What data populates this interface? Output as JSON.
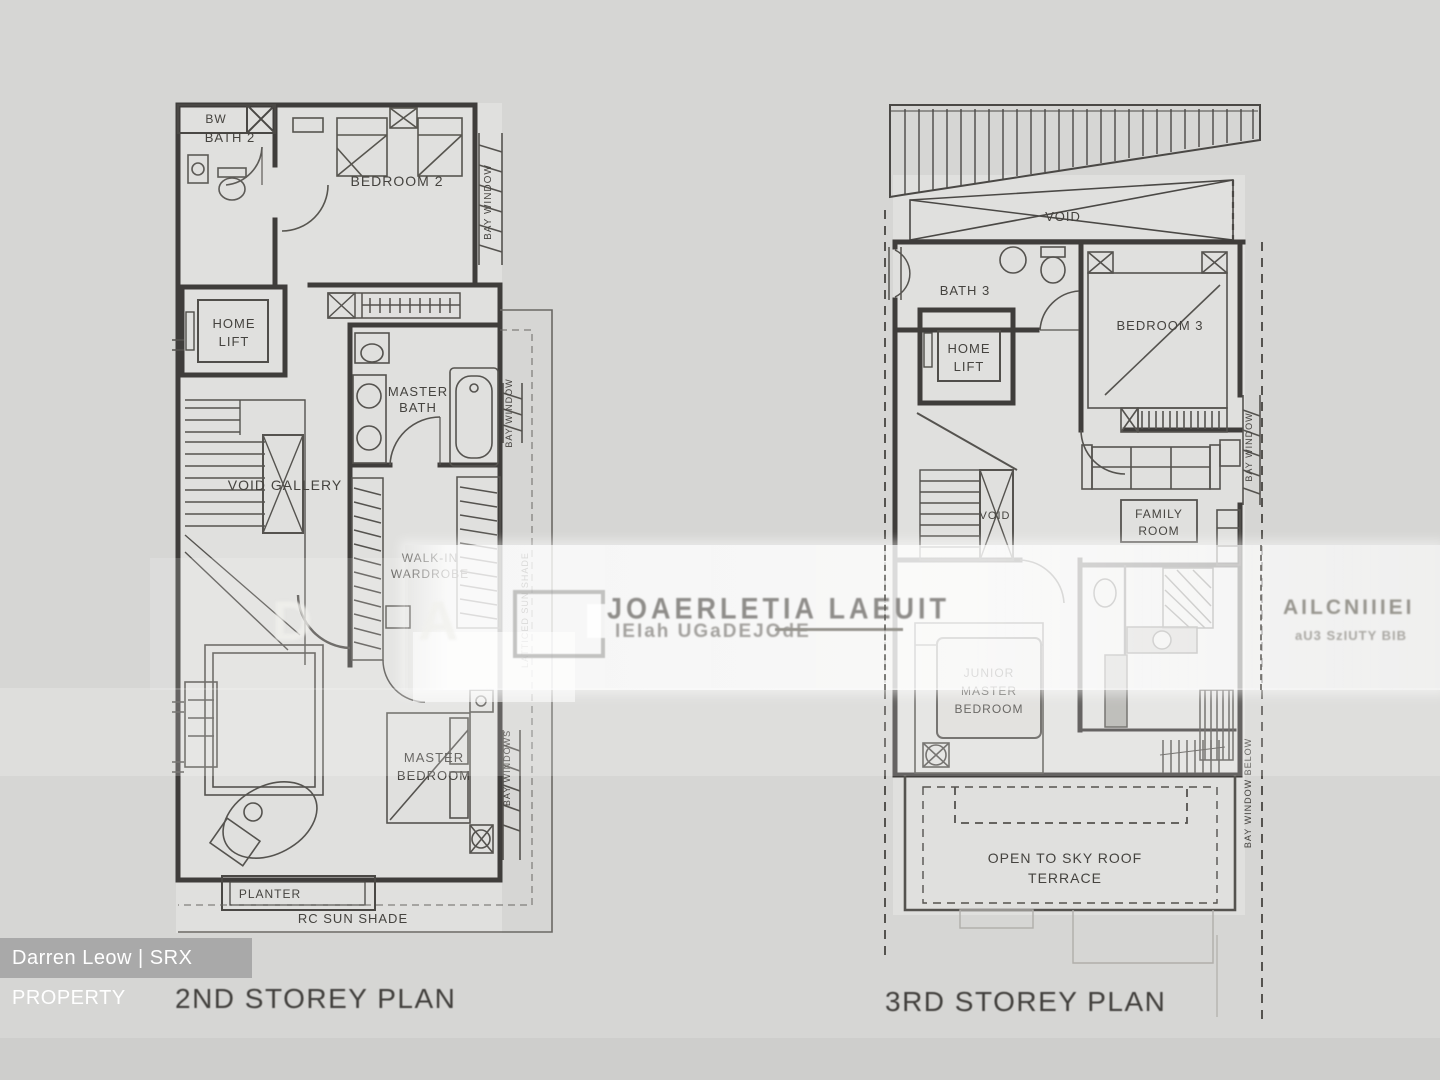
{
  "colors": {
    "background": "#d6d6d4",
    "wall": "#3f3d3b",
    "badge_bg": "#a9a9a9",
    "badge_text": "#ffffff"
  },
  "left_plan": {
    "title": "2ND STOREY PLAN",
    "labels": {
      "bw": "BW",
      "bath2": "BATH 2",
      "bedroom2": "BEDROOM 2",
      "bay_window_bedroom2": "BAY WINDOW",
      "home_lift_l1": "HOME",
      "home_lift_l2": "LIFT",
      "master_bath_l1": "MASTER",
      "master_bath_l2": "BATH",
      "bay_window_bath": "BAY WINDOW",
      "void_gallery": "VOID GALLERY",
      "walk_in_l1": "WALK-IN",
      "walk_in_l2": "WARDROBE",
      "side_shade": "LATTICED SUN SHADE",
      "master_bedroom_l1": "MASTER",
      "master_bedroom_l2": "BEDROOM",
      "bay_windows": "BAY WINDOWS",
      "planter": "PLANTER",
      "rc_sun_shade": "RC SUN SHADE"
    }
  },
  "right_plan": {
    "title": "3RD STOREY PLAN",
    "labels": {
      "void_roof": "VOID",
      "bath3": "BATH 3",
      "bedroom3": "BEDROOM 3",
      "home_lift_l1": "HOME",
      "home_lift_l2": "LIFT",
      "bay_window": "BAY WINDOW",
      "void_stair": "VOID",
      "family_l1": "FAMILY",
      "family_l2": "ROOM",
      "junior_l1": "JUNIOR",
      "junior_l2": "MASTER",
      "junior_l3": "BEDROOM",
      "terrace_l1": "OPEN TO SKY ROOF",
      "terrace_l2": "TERRACE",
      "bay_window_below": "BAY WINDOW BELOW"
    }
  },
  "watermarks": {
    "center_line1": "JOAERLETIA LAEUIT",
    "center_line2": "IEIah UGaDEJOdE",
    "right_line1": "AILCNIIIEI",
    "right_line2": "aU3 SzIUTY BIB",
    "ghost_letters": "D A",
    "agent_badge": "Darren Leow | SRX PROPERTY"
  }
}
